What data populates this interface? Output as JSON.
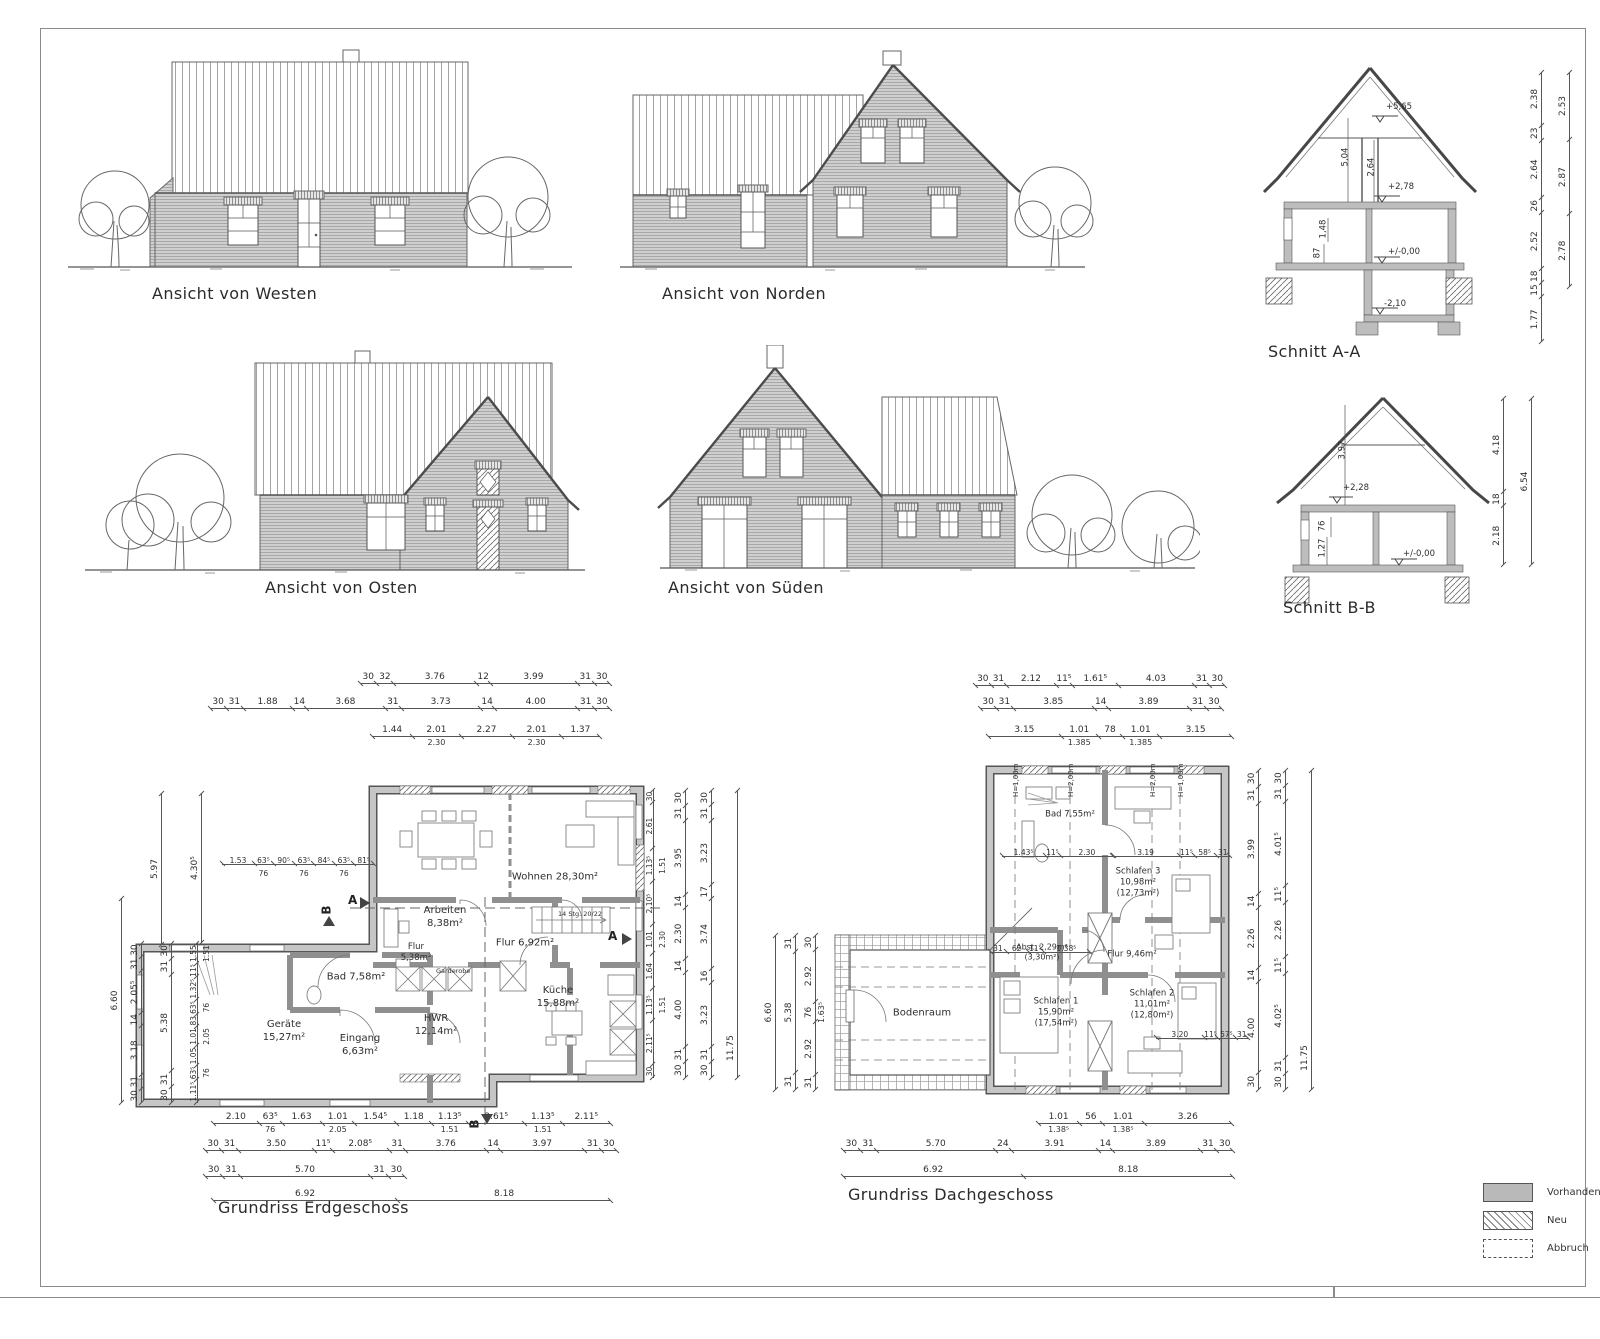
{
  "labels": {
    "west": "Ansicht von Westen",
    "north": "Ansicht von Norden",
    "east": "Ansicht von Osten",
    "south": "Ansicht von Süden",
    "schnitt_aa": "Schnitt A-A",
    "schnitt_bb": "Schnitt B-B"
  },
  "sections": {
    "aa": {
      "level_top": "+5,65",
      "level_og": "+2,78",
      "level_eg": "+/-0,00",
      "level_keller": "-2,10",
      "dim_roof": "5,04",
      "dim_attic": "2,64",
      "dim_148": "1,48",
      "dim_87": "87",
      "chain_inner": [
        "1.77",
        "15",
        "18",
        "2.52",
        "26",
        "2.64",
        "23",
        "2.38"
      ],
      "chain_outer": [
        "2.78",
        "2.87",
        "2.53"
      ]
    },
    "bb": {
      "level_og": "+2,28",
      "level_eg": "+/-0,00",
      "dim_roof": "3,97",
      "dim_76": "76",
      "dim_127": "1,27",
      "chain_inner": [
        "2.18",
        "18",
        "4.18"
      ],
      "chain_outer": [
        "6.54"
      ]
    }
  },
  "eg": {
    "label": "Grundriss Erdgeschoss",
    "rooms": [
      {
        "name": "Wohnen",
        "area": "28,30m²"
      },
      {
        "name": "Arbeiten",
        "area": "8,38m²"
      },
      {
        "name": "Flur",
        "area": "6,92m²"
      },
      {
        "name": "Flur",
        "area": "5,38m²"
      },
      {
        "name": "Bad",
        "area": "7,58m²"
      },
      {
        "name": "Geräte",
        "area": "15,27m²"
      },
      {
        "name": "Eingang",
        "area": "6,63m²"
      },
      {
        "name": "HWR",
        "area": "12,14m²"
      },
      {
        "name": "Küche",
        "area": "15,88m²"
      }
    ],
    "extra": {
      "garderobe": "Garderobe",
      "stair": "14 Stg. 20/22"
    },
    "markers": {
      "a": "A",
      "b": "B"
    },
    "chains": {
      "top1": [
        "30",
        "32",
        "3.76",
        "12",
        "3.99",
        "31",
        "30"
      ],
      "top2": [
        "30",
        "31",
        "1.88",
        "14",
        "3.68",
        "31",
        "3.73",
        "14",
        "4.00",
        "31",
        "30"
      ],
      "top3": [
        "1.44",
        "2.01|2.30",
        "2.27",
        "2.01|2.30",
        "1.37"
      ],
      "interior": [
        "1.53",
        "63⁵|76",
        "90⁵",
        "63⁵|76",
        "84⁵",
        "63⁵|76",
        "81⁵"
      ],
      "bot1": [
        "2.10",
        "63⁵|76",
        "1.63",
        "1.01|2.05",
        "1.54⁵",
        "1.18",
        "1.13⁵|1.51",
        "2.61⁵",
        "1.13⁵|1.51",
        "2.11⁵"
      ],
      "bot2": [
        "30",
        "31",
        "3.50",
        "11⁵",
        "2.08⁵",
        "31",
        "3.76",
        "14",
        "3.97",
        "31",
        "30"
      ],
      "bot3": [
        "30",
        "31",
        "5.70",
        "31",
        "30"
      ],
      "bot4": [
        "6.92",
        "8.18"
      ],
      "left_outer": [
        "6.60"
      ],
      "left_mid1": [
        "30",
        "31",
        "3.18",
        "14",
        "2.05⁵",
        "31",
        "30"
      ],
      "left_mid2": [
        "30",
        "31",
        "5.38",
        "31",
        "30"
      ],
      "left_inner": [
        "1.11⁵",
        "63⁵|76",
        "1.05",
        "1.01|2.05",
        "83",
        "63⁵|76",
        "1.32⁵",
        "11⁵",
        "1.55|1.51"
      ],
      "left_430": [
        "4.30⁵"
      ],
      "left_597": [
        "5.97"
      ],
      "right_inner": [
        "30",
        "2.11⁵",
        "1.13⁵|1.51",
        "1.64",
        "1.01|2.30",
        "2.10⁵",
        "1.13⁵|1.51",
        "2.61",
        "30"
      ],
      "right_mid": [
        "30",
        "31",
        "4.00",
        "14",
        "2.30",
        "14",
        "3.95",
        "31",
        "30"
      ],
      "right_outer": [
        "30",
        "31",
        "3.23",
        "16",
        "3.74",
        "17",
        "3.23",
        "31",
        "30"
      ],
      "right_total": [
        "11.75"
      ]
    }
  },
  "og": {
    "label": "Grundriss Dachgeschoss",
    "rooms": [
      {
        "name": "Bodenraum",
        "area": ""
      },
      {
        "name": "Bad",
        "area": "7,55m²"
      },
      {
        "name": "Schlafen 3",
        "area": "10,98m²",
        "area2": "(12,73m²)"
      },
      {
        "name": "Abst.",
        "area": "2,29m²",
        "area2": "(3,30m²)"
      },
      {
        "name": "Schlafen 1",
        "area": "15,90m²",
        "area2": "(17,54m²)"
      },
      {
        "name": "Schlafen 2",
        "area": "11,01m²",
        "area2": "(12,80m²)"
      },
      {
        "name": "Flur",
        "area": "9,46m²"
      }
    ],
    "height_labels": [
      "H=1,00m",
      "H=2,00m",
      "H=2,00m",
      "H=1,00m"
    ],
    "chains": {
      "top1": [
        "30",
        "31",
        "2.12",
        "11⁵",
        "1.61⁵",
        "4.03",
        "31",
        "30"
      ],
      "top2": [
        "30",
        "31",
        "3.85",
        "14",
        "3.89",
        "31",
        "30"
      ],
      "top3": [
        "3.15",
        "1.01|1.385",
        "78",
        "1.01|1.385",
        "3.15"
      ],
      "bot1": [
        "1.01|1.38⁵",
        "56",
        "1.01|1.38⁵",
        "3.26"
      ],
      "bot2": [
        "30",
        "31",
        "5.70",
        "24",
        "3.91",
        "14",
        "3.89",
        "31",
        "30"
      ],
      "bot3": [
        "6.92",
        "8.18"
      ],
      "left_inner": [
        "31",
        "2.92",
        "76|1.63⁵",
        "2.92",
        "30"
      ],
      "left_mid": [
        "31",
        "5.38",
        "31"
      ],
      "left_outer": [
        "6.60"
      ],
      "right_inner": [
        "30",
        "4.00",
        "14",
        "2.26",
        "14",
        "3.99",
        "31",
        "30"
      ],
      "right_mid": [
        "30",
        "31",
        "4.02⁵",
        "11⁵",
        "2.26",
        "11⁵",
        "4.01⁵",
        "31",
        "30"
      ],
      "right_total": [
        "11.75"
      ],
      "int1": [
        "1.43⁵",
        "11⁵",
        "2.30"
      ],
      "int2": [
        "3.19",
        "11⁵",
        "58⁵",
        "31"
      ],
      "int3": [
        "31",
        "62",
        "11⁵",
        "1.38⁵"
      ],
      "int4": [
        "3.20",
        "11⁵",
        "57⁵",
        "31"
      ]
    }
  },
  "legend": {
    "items": [
      {
        "label": "Vorhanden",
        "type": "existing"
      },
      {
        "label": "Neu",
        "type": "new"
      },
      {
        "label": "Abbruch",
        "type": "demo"
      }
    ]
  }
}
